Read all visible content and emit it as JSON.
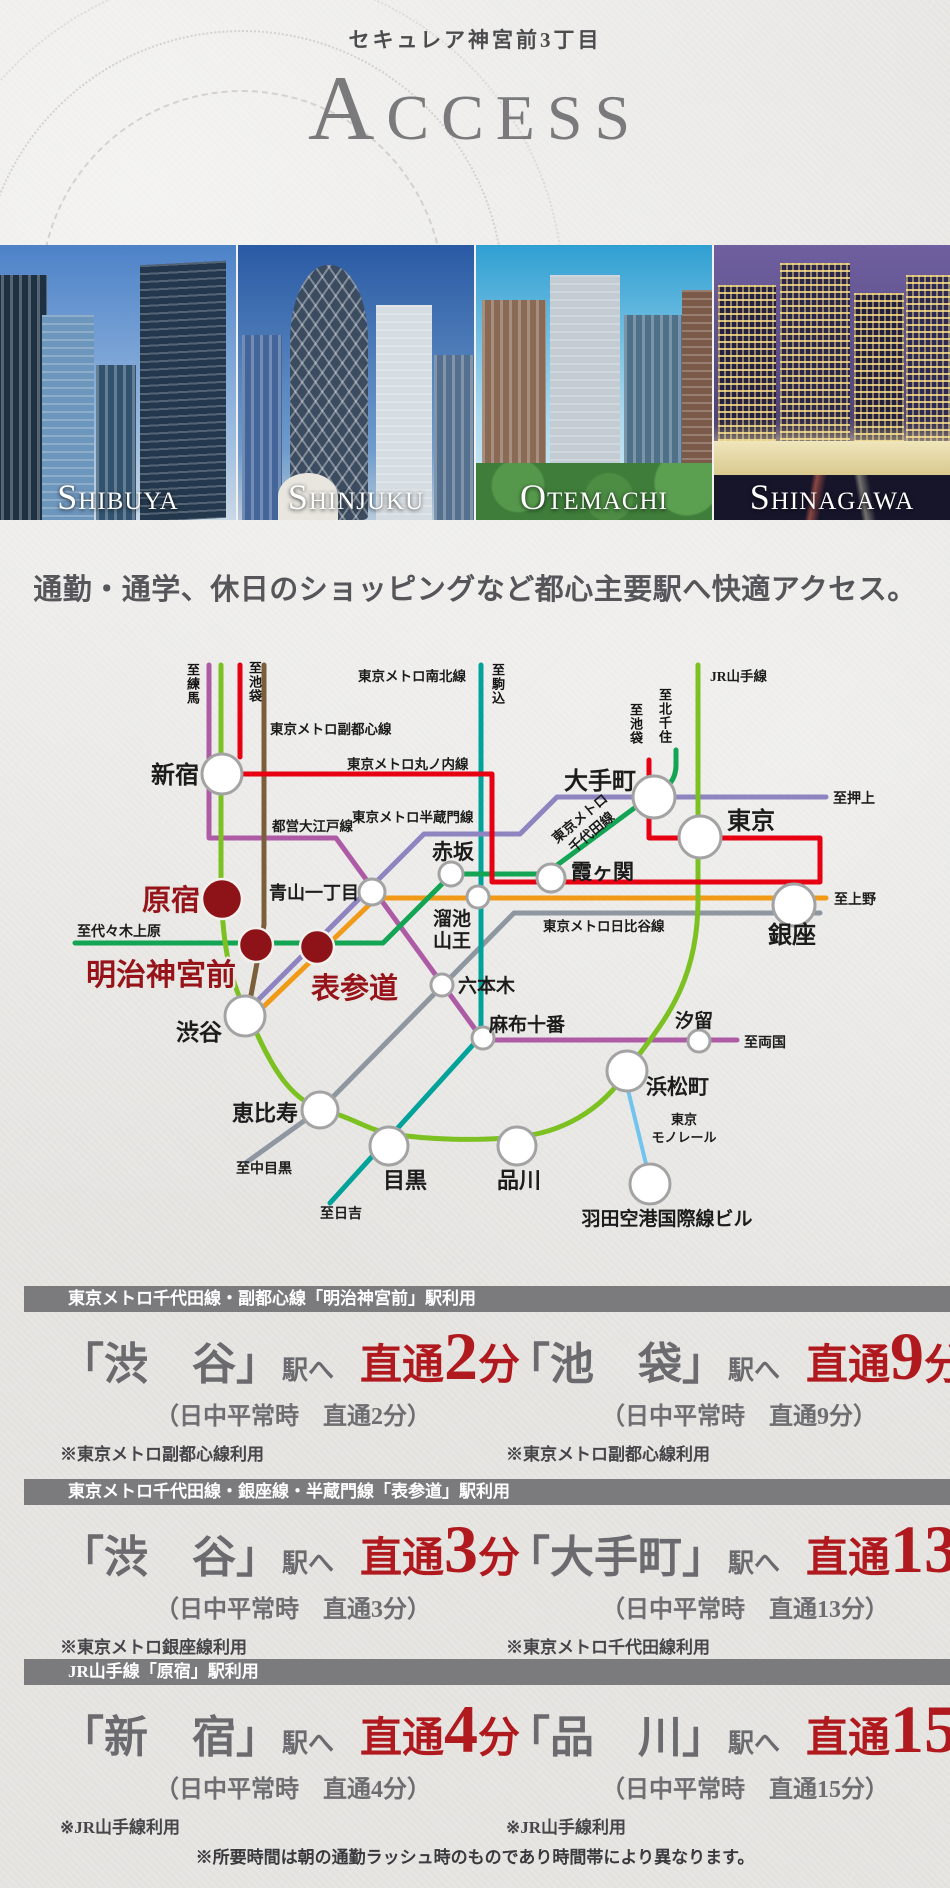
{
  "header": {
    "subtitle": "セキュレア神宮前3丁目",
    "title": "Access"
  },
  "photos": [
    {
      "caption": "Shibuya"
    },
    {
      "caption": "Shinjuku"
    },
    {
      "caption": "Otemachi"
    },
    {
      "caption": "Shinagawa"
    }
  ],
  "tagline": "通勤・通学、休日のショッピングなど都心主要駅へ快適アクセス。",
  "map": {
    "colors": {
      "yamanote": "#7cc121",
      "marunouchi": "#e60012",
      "oedo": "#ad5ba5",
      "fukutoshin": "#7a5f3a",
      "namboku": "#00a29a",
      "chiyoda": "#13a454",
      "ginza": "#f09a18",
      "hanzomon": "#8d84c0",
      "hibiya": "#8e97a0",
      "monorail": "#71c4ee",
      "property": "#8e1319"
    },
    "stations": {
      "shinjuku": "新宿",
      "otemachi": "大手町",
      "tokyo": "東京",
      "ginza": "銀座",
      "shibuya": "渋谷",
      "ebisu": "恵比寿",
      "meguro": "目黒",
      "shinagawa": "品川",
      "hamamatsucho": "浜松町",
      "kasumigaseki": "霞ヶ関",
      "akasaka": "赤坂",
      "aoyama_itchome": "青山一丁目",
      "tameike_l1": "溜池",
      "tameike_l2": "山王",
      "roppongi": "六本木",
      "azabujuban": "麻布十番",
      "shiodome": "汐留",
      "haneda": "羽田空港国際線ビル",
      "harajuku": "原宿",
      "meiji_jingumae": "明治神宮前",
      "omotesando": "表参道",
      "monorail_l1": "東京",
      "monorail_l2": "モノレール"
    },
    "lines": {
      "namboku": "東京メトロ南北線",
      "fukutoshin": "東京メトロ副都心線",
      "marunouchi": "東京メトロ丸ノ内線",
      "oedo": "都営大江戸線",
      "hanzomon": "東京メトロ半蔵門線",
      "chiyoda_l1": "東京メトロ",
      "chiyoda_l2": "千代田線",
      "hibiya": "東京メトロ日比谷線",
      "yamanote": "JR山手線"
    },
    "directions": {
      "nerima": "至練馬",
      "ikebukuro_west": "至池袋",
      "komagome": "至駒込",
      "kitasenju": "至北千住",
      "ikebukuro_east": "至池袋",
      "oshiage": "至押上",
      "ueno": "至上野",
      "ryogoku": "至両国",
      "yoyogi_uehara": "至代々木上原",
      "nakameguro": "至中目黒",
      "hiyoshi": "至日吉"
    }
  },
  "ui": {
    "bracket_open": "「",
    "bracket_close": "」"
  },
  "sections": [
    {
      "heading": "東京メトロ千代田線・副都心線「明治神宮前」駅利用",
      "items": [
        {
          "station": "渋　谷",
          "via": "駅へ",
          "direct": "直通",
          "minutes": "2",
          "unit": "分",
          "daytime": "（日中平常時　直通2分）",
          "note": "※東京メトロ副都心線利用"
        },
        {
          "station": "池　袋",
          "via": "駅へ",
          "direct": "直通",
          "minutes": "9",
          "unit": "分",
          "daytime": "（日中平常時　直通9分）",
          "note": "※東京メトロ副都心線利用"
        }
      ]
    },
    {
      "heading": "東京メトロ千代田線・銀座線・半蔵門線「表参道」駅利用",
      "items": [
        {
          "station": "渋　谷",
          "via": "駅へ",
          "direct": "直通",
          "minutes": "3",
          "unit": "分",
          "daytime": "（日中平常時　直通3分）",
          "note": "※東京メトロ銀座線利用"
        },
        {
          "station": "大手町",
          "via": "駅へ",
          "direct": "直通",
          "minutes": "13",
          "unit": "分",
          "daytime": "（日中平常時　直通13分）",
          "note": "※東京メトロ千代田線利用"
        }
      ]
    },
    {
      "heading": "JR山手線「原宿」駅利用",
      "items": [
        {
          "station": "新　宿",
          "via": "駅へ",
          "direct": "直通",
          "minutes": "4",
          "unit": "分",
          "daytime": "（日中平常時　直通4分）",
          "note": "※JR山手線利用"
        },
        {
          "station": "品　川",
          "via": "駅へ",
          "direct": "直通",
          "minutes": "15",
          "unit": "分",
          "daytime": "（日中平常時　直通15分）",
          "note": "※JR山手線利用"
        }
      ]
    }
  ],
  "footnote": "※所要時間は朝の通勤ラッシュ時のものであり時間帯により異なります。"
}
